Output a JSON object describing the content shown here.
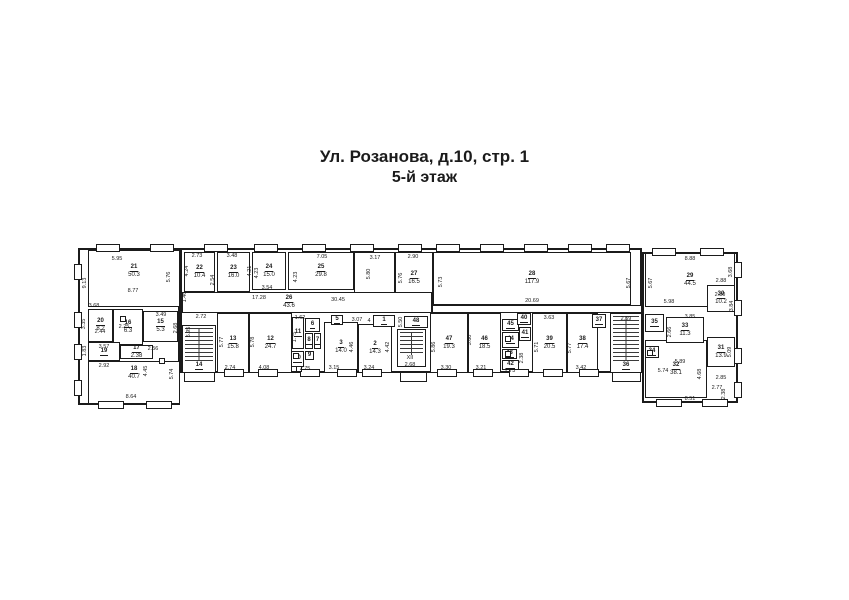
{
  "title": {
    "line1": "Ул. Розанова, д.10, стр. 1",
    "line2": "5-й этаж"
  },
  "colors": {
    "wall": "#1b1b1b",
    "text": "#1b1b1b",
    "paper": "#ffffff"
  },
  "plan": {
    "outlines": [
      {
        "x": 78,
        "y": 248,
        "w": 102,
        "h": 157
      },
      {
        "x": 180,
        "y": 248,
        "w": 462,
        "h": 125
      },
      {
        "x": 642,
        "y": 252,
        "w": 96,
        "h": 151
      }
    ],
    "rooms": [
      {
        "n": "21",
        "a": "50.3",
        "x": 88,
        "y": 250,
        "w": 92,
        "h": 57,
        "oy": -7
      },
      {
        "n": "22",
        "a": "10.4",
        "x": 184,
        "y": 252,
        "w": 31,
        "h": 40
      },
      {
        "n": "23",
        "a": "16.0",
        "x": 217,
        "y": 252,
        "w": 33,
        "h": 40
      },
      {
        "n": "24",
        "a": "15.0",
        "x": 252,
        "y": 252,
        "w": 34,
        "h": 38
      },
      {
        "n": "25",
        "a": "29.8",
        "x": 288,
        "y": 252,
        "w": 66,
        "h": 38
      },
      {
        "n": "",
        "a": "",
        "x": 354,
        "y": 252,
        "w": 41,
        "h": 53
      },
      {
        "n": "27",
        "a": "16.5",
        "x": 395,
        "y": 252,
        "w": 38,
        "h": 53
      },
      {
        "n": "28",
        "a": "117.9",
        "x": 433,
        "y": 252,
        "w": 198,
        "h": 53
      },
      {
        "n": "26",
        "a": "43.6",
        "x": 182,
        "y": 292,
        "w": 250,
        "h": 21,
        "ox": -18
      },
      {
        "n": "",
        "a": "",
        "x": 432,
        "y": 305,
        "w": 210,
        "h": 8
      },
      {
        "n": "29",
        "a": "44.5",
        "x": 645,
        "y": 253,
        "w": 90,
        "h": 54
      },
      {
        "n": "30",
        "a": "10.2",
        "x": 707,
        "y": 285,
        "w": 28,
        "h": 27
      },
      {
        "n": "20",
        "a": "8.2",
        "x": 88,
        "y": 309,
        "w": 25,
        "h": 33
      },
      {
        "n": "16",
        "a": "6.3",
        "x": 113,
        "y": 309,
        "w": 30,
        "h": 36
      },
      {
        "n": "15",
        "a": "5.3",
        "x": 143,
        "y": 311,
        "w": 35,
        "h": 31
      },
      {
        "n": "19",
        "a": "",
        "x": 88,
        "y": 342,
        "w": 32,
        "h": 19
      },
      {
        "n": "17",
        "a": "2.38",
        "x": 120,
        "y": 345,
        "w": 33,
        "h": 14
      },
      {
        "n": "18",
        "a": "40.7",
        "x": 88,
        "y": 361,
        "w": 92,
        "h": 43,
        "oy": -9
      },
      {
        "n": "14",
        "a": "",
        "x": 182,
        "y": 325,
        "w": 34,
        "h": 48,
        "stairs": true,
        "lb": true
      },
      {
        "n": "13",
        "a": "15.8",
        "x": 217,
        "y": 313,
        "w": 32,
        "h": 60
      },
      {
        "n": "12",
        "a": "24.7",
        "x": 249,
        "y": 313,
        "w": 43,
        "h": 60
      },
      {
        "n": "11",
        "a": "",
        "x": 292,
        "y": 317,
        "w": 12,
        "h": 32
      },
      {
        "n": "6",
        "a": "",
        "x": 305,
        "y": 318,
        "w": 15,
        "h": 14
      },
      {
        "n": "8",
        "a": "",
        "x": 305,
        "y": 333,
        "w": 8,
        "h": 16
      },
      {
        "n": "7",
        "a": "",
        "x": 314,
        "y": 333,
        "w": 7,
        "h": 16
      },
      {
        "n": "10",
        "a": "",
        "x": 291,
        "y": 351,
        "w": 13,
        "h": 16
      },
      {
        "n": "9",
        "a": "",
        "x": 305,
        "y": 351,
        "w": 9,
        "h": 9
      },
      {
        "n": "3",
        "a": "14.0",
        "x": 324,
        "y": 322,
        "w": 34,
        "h": 51
      },
      {
        "n": "2",
        "a": "14.3",
        "x": 358,
        "y": 324,
        "w": 34,
        "h": 49
      },
      {
        "n": "5",
        "a": "",
        "x": 331,
        "y": 315,
        "w": 12,
        "h": 10
      },
      {
        "n": "1",
        "a": "",
        "x": 373,
        "y": 315,
        "w": 22,
        "h": 12
      },
      {
        "n": "48",
        "a": "",
        "x": 404,
        "y": 316,
        "w": 24,
        "h": 12
      },
      {
        "n": "",
        "a": "",
        "x": 397,
        "y": 329,
        "w": 29,
        "h": 38,
        "stairs": true
      },
      {
        "n": "47",
        "a": "19.3",
        "x": 430,
        "y": 313,
        "w": 38,
        "h": 60
      },
      {
        "n": "46",
        "a": "18.5",
        "x": 468,
        "y": 313,
        "w": 33,
        "h": 60
      },
      {
        "n": "45",
        "a": "",
        "x": 502,
        "y": 319,
        "w": 17,
        "h": 12
      },
      {
        "n": "40",
        "a": "",
        "x": 517,
        "y": 313,
        "w": 14,
        "h": 12
      },
      {
        "n": "41",
        "a": "",
        "x": 519,
        "y": 327,
        "w": 12,
        "h": 14
      },
      {
        "n": "44",
        "a": "",
        "x": 502,
        "y": 332,
        "w": 17,
        "h": 16
      },
      {
        "n": "43",
        "a": "",
        "x": 502,
        "y": 349,
        "w": 15,
        "h": 10
      },
      {
        "n": "42",
        "a": "",
        "x": 502,
        "y": 360,
        "w": 17,
        "h": 10
      },
      {
        "n": "39",
        "a": "20.5",
        "x": 532,
        "y": 313,
        "w": 35,
        "h": 60
      },
      {
        "n": "38",
        "a": "17.4",
        "x": 567,
        "y": 313,
        "w": 31,
        "h": 60
      },
      {
        "n": "37",
        "a": "",
        "x": 592,
        "y": 314,
        "w": 14,
        "h": 14
      },
      {
        "n": "36",
        "a": "",
        "x": 610,
        "y": 313,
        "w": 32,
        "h": 60,
        "stairs": true,
        "lb": true
      },
      {
        "n": "32",
        "a": "38.1",
        "x": 645,
        "y": 340,
        "w": 62,
        "h": 58
      },
      {
        "n": "35",
        "a": "",
        "x": 645,
        "y": 314,
        "w": 19,
        "h": 18
      },
      {
        "n": "33",
        "a": "11.3",
        "x": 666,
        "y": 317,
        "w": 38,
        "h": 26
      },
      {
        "n": "34",
        "a": "",
        "x": 645,
        "y": 346,
        "w": 14,
        "h": 12
      },
      {
        "n": "31",
        "a": "13.9",
        "x": 707,
        "y": 337,
        "w": 28,
        "h": 30
      }
    ],
    "dims": [
      {
        "t": "5.95",
        "x": 117,
        "y": 259
      },
      {
        "t": "9.13",
        "x": 85,
        "y": 283,
        "v": 1
      },
      {
        "t": "8.77",
        "x": 133,
        "y": 291
      },
      {
        "t": "5.76",
        "x": 169,
        "y": 277,
        "v": 1
      },
      {
        "t": "3.68",
        "x": 94,
        "y": 306
      },
      {
        "t": "3.35",
        "x": 84,
        "y": 324,
        "v": 1
      },
      {
        "t": "2.44",
        "x": 100,
        "y": 332
      },
      {
        "t": "2.25",
        "x": 124,
        "y": 327
      },
      {
        "t": "3.49",
        "x": 161,
        "y": 315
      },
      {
        "t": "2.68",
        "x": 176,
        "y": 328,
        "v": 1
      },
      {
        "t": "3.57",
        "x": 104,
        "y": 347
      },
      {
        "t": "1.83",
        "x": 85,
        "y": 351,
        "v": 1
      },
      {
        "t": "2.92",
        "x": 104,
        "y": 366
      },
      {
        "t": "2.56",
        "x": 153,
        "y": 349
      },
      {
        "t": "4.45",
        "x": 146,
        "y": 371,
        "v": 1
      },
      {
        "t": "5.74",
        "x": 172,
        "y": 374,
        "v": 1
      },
      {
        "t": "8.64",
        "x": 131,
        "y": 397
      },
      {
        "t": "1.46",
        "x": 185,
        "y": 297,
        "v": 1
      },
      {
        "t": "2.72",
        "x": 201,
        "y": 317
      },
      {
        "t": "5.95",
        "x": 189,
        "y": 332,
        "v": 1
      },
      {
        "t": "2.73",
        "x": 197,
        "y": 256
      },
      {
        "t": "4.24",
        "x": 187,
        "y": 271,
        "v": 1
      },
      {
        "t": "2.54",
        "x": 213,
        "y": 280,
        "v": 1
      },
      {
        "t": "3.48",
        "x": 232,
        "y": 256
      },
      {
        "t": "4.21",
        "x": 250,
        "y": 271,
        "v": 1
      },
      {
        "t": "4.23",
        "x": 257,
        "y": 273,
        "v": 1
      },
      {
        "t": "3.54",
        "x": 267,
        "y": 288
      },
      {
        "t": "7.05",
        "x": 322,
        "y": 257
      },
      {
        "t": "4.23",
        "x": 296,
        "y": 277,
        "v": 1
      },
      {
        "t": "17.28",
        "x": 259,
        "y": 298
      },
      {
        "t": "30.45",
        "x": 338,
        "y": 300
      },
      {
        "t": "3.17",
        "x": 375,
        "y": 258
      },
      {
        "t": "5.80",
        "x": 369,
        "y": 274,
        "v": 1
      },
      {
        "t": "2.90",
        "x": 413,
        "y": 257
      },
      {
        "t": "5.76",
        "x": 401,
        "y": 278,
        "v": 1
      },
      {
        "t": "5.73",
        "x": 441,
        "y": 282,
        "v": 1
      },
      {
        "t": "20.69",
        "x": 532,
        "y": 301
      },
      {
        "t": "5.67",
        "x": 629,
        "y": 283,
        "v": 1
      },
      {
        "t": "8.88",
        "x": 690,
        "y": 259
      },
      {
        "t": "5.67",
        "x": 651,
        "y": 283,
        "v": 1
      },
      {
        "t": "3.68",
        "x": 731,
        "y": 272,
        "v": 1
      },
      {
        "t": "2.88",
        "x": 721,
        "y": 281
      },
      {
        "t": "2.80",
        "x": 720,
        "y": 295
      },
      {
        "t": "3.84",
        "x": 732,
        "y": 306,
        "v": 1
      },
      {
        "t": "5.98",
        "x": 669,
        "y": 302
      },
      {
        "t": "2.59",
        "x": 626,
        "y": 319
      },
      {
        "t": "3.85",
        "x": 690,
        "y": 317
      },
      {
        "t": "2.66",
        "x": 670,
        "y": 332,
        "v": 1
      },
      {
        "t": "5.09",
        "x": 730,
        "y": 352,
        "v": 1
      },
      {
        "t": "2.85",
        "x": 721,
        "y": 378
      },
      {
        "t": "2.77",
        "x": 717,
        "y": 388
      },
      {
        "t": "2.38",
        "x": 724,
        "y": 394,
        "v": 1
      },
      {
        "t": "5.89",
        "x": 680,
        "y": 362
      },
      {
        "t": "5.74",
        "x": 663,
        "y": 371
      },
      {
        "t": "8.51",
        "x": 690,
        "y": 399
      },
      {
        "t": "4.68",
        "x": 700,
        "y": 374,
        "v": 1
      },
      {
        "t": "5.77",
        "x": 222,
        "y": 342,
        "v": 1
      },
      {
        "t": "2.74",
        "x": 230,
        "y": 368
      },
      {
        "t": "5.78",
        "x": 253,
        "y": 342,
        "v": 1
      },
      {
        "t": "4.08",
        "x": 264,
        "y": 368
      },
      {
        "t": "1.62",
        "x": 300,
        "y": 318
      },
      {
        "t": "1.75",
        "x": 295,
        "y": 337,
        "v": 1
      },
      {
        "t": "2.75",
        "x": 305,
        "y": 369
      },
      {
        "t": "3.15",
        "x": 334,
        "y": 368
      },
      {
        "t": "4.46",
        "x": 352,
        "y": 347,
        "v": 1
      },
      {
        "t": "3.24",
        "x": 369,
        "y": 368
      },
      {
        "t": "4.42",
        "x": 388,
        "y": 347,
        "v": 1
      },
      {
        "t": "3.07",
        "x": 357,
        "y": 320
      },
      {
        "t": "4",
        "x": 369,
        "y": 321
      },
      {
        "t": "5.50",
        "x": 401,
        "y": 322,
        "v": 1
      },
      {
        "t": "XII",
        "x": 410,
        "y": 358
      },
      {
        "t": "2.68",
        "x": 410,
        "y": 365
      },
      {
        "t": "5.86",
        "x": 434,
        "y": 347,
        "v": 1
      },
      {
        "t": "3.30",
        "x": 446,
        "y": 368
      },
      {
        "t": "5.60",
        "x": 470,
        "y": 340,
        "v": 1
      },
      {
        "t": "3.21",
        "x": 481,
        "y": 368
      },
      {
        "t": "2.38",
        "x": 522,
        "y": 358,
        "v": 1
      },
      {
        "t": "2.73",
        "x": 510,
        "y": 371
      },
      {
        "t": "3.63",
        "x": 549,
        "y": 318
      },
      {
        "t": "5.71",
        "x": 537,
        "y": 347,
        "v": 1
      },
      {
        "t": "5.77",
        "x": 570,
        "y": 348,
        "v": 1
      },
      {
        "t": "3.42",
        "x": 581,
        "y": 368
      }
    ],
    "windows": [
      {
        "x": 96,
        "y": 244,
        "w": 24,
        "h": 8
      },
      {
        "x": 150,
        "y": 244,
        "w": 24,
        "h": 8
      },
      {
        "x": 204,
        "y": 244,
        "w": 24,
        "h": 8
      },
      {
        "x": 254,
        "y": 244,
        "w": 24,
        "h": 8
      },
      {
        "x": 302,
        "y": 244,
        "w": 24,
        "h": 8
      },
      {
        "x": 350,
        "y": 244,
        "w": 24,
        "h": 8
      },
      {
        "x": 398,
        "y": 244,
        "w": 24,
        "h": 8
      },
      {
        "x": 436,
        "y": 244,
        "w": 24,
        "h": 8
      },
      {
        "x": 480,
        "y": 244,
        "w": 24,
        "h": 8
      },
      {
        "x": 524,
        "y": 244,
        "w": 24,
        "h": 8
      },
      {
        "x": 568,
        "y": 244,
        "w": 24,
        "h": 8
      },
      {
        "x": 606,
        "y": 244,
        "w": 24,
        "h": 8
      },
      {
        "x": 652,
        "y": 248,
        "w": 24,
        "h": 8
      },
      {
        "x": 700,
        "y": 248,
        "w": 24,
        "h": 8
      },
      {
        "x": 224,
        "y": 369,
        "w": 20,
        "h": 8
      },
      {
        "x": 258,
        "y": 369,
        "w": 20,
        "h": 8
      },
      {
        "x": 300,
        "y": 369,
        "w": 20,
        "h": 8
      },
      {
        "x": 337,
        "y": 369,
        "w": 20,
        "h": 8
      },
      {
        "x": 362,
        "y": 369,
        "w": 20,
        "h": 8
      },
      {
        "x": 437,
        "y": 369,
        "w": 20,
        "h": 8
      },
      {
        "x": 473,
        "y": 369,
        "w": 20,
        "h": 8
      },
      {
        "x": 509,
        "y": 369,
        "w": 20,
        "h": 8
      },
      {
        "x": 543,
        "y": 369,
        "w": 20,
        "h": 8
      },
      {
        "x": 579,
        "y": 369,
        "w": 20,
        "h": 8
      },
      {
        "x": 98,
        "y": 401,
        "w": 26,
        "h": 8
      },
      {
        "x": 146,
        "y": 401,
        "w": 26,
        "h": 8
      },
      {
        "x": 656,
        "y": 399,
        "w": 26,
        "h": 8
      },
      {
        "x": 702,
        "y": 399,
        "w": 26,
        "h": 8
      },
      {
        "x": 74,
        "y": 264,
        "w": 8,
        "h": 16
      },
      {
        "x": 74,
        "y": 312,
        "w": 8,
        "h": 16
      },
      {
        "x": 74,
        "y": 344,
        "w": 8,
        "h": 16
      },
      {
        "x": 74,
        "y": 380,
        "w": 8,
        "h": 16
      },
      {
        "x": 734,
        "y": 262,
        "w": 8,
        "h": 16
      },
      {
        "x": 734,
        "y": 300,
        "w": 8,
        "h": 16
      },
      {
        "x": 734,
        "y": 348,
        "w": 8,
        "h": 16
      },
      {
        "x": 734,
        "y": 382,
        "w": 8,
        "h": 16
      }
    ],
    "porches": [
      {
        "x": 184,
        "y": 373,
        "w": 31,
        "h": 9
      },
      {
        "x": 400,
        "y": 373,
        "w": 27,
        "h": 9
      },
      {
        "x": 612,
        "y": 373,
        "w": 29,
        "h": 9
      }
    ],
    "fixtures": [
      {
        "x": 120,
        "y": 316
      },
      {
        "x": 159,
        "y": 358
      },
      {
        "x": 293,
        "y": 353
      },
      {
        "x": 505,
        "y": 336
      },
      {
        "x": 505,
        "y": 351
      },
      {
        "x": 647,
        "y": 350
      },
      {
        "x": 296,
        "y": 366
      }
    ]
  }
}
